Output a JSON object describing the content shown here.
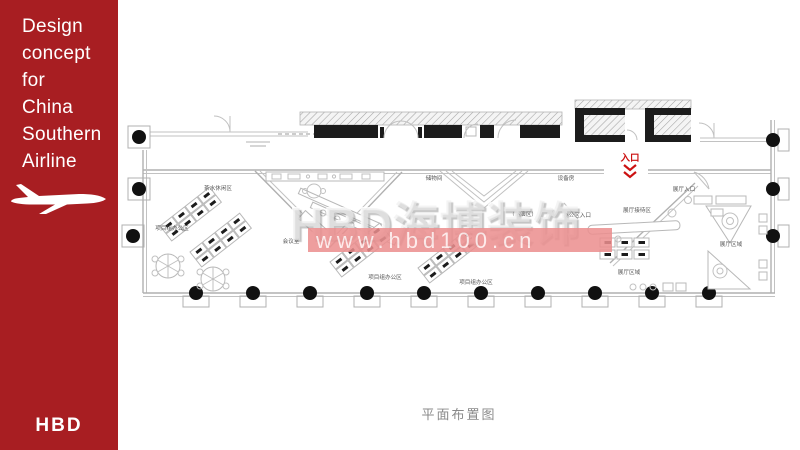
{
  "sidebar": {
    "bg_color": "#a81e22",
    "title_lines": [
      "Design",
      "concept",
      "for",
      "China",
      "Southern",
      "Airline"
    ],
    "logo_text": "HBD"
  },
  "watermark": {
    "brand": "HBD海博装饰",
    "url": "www.hbd100.cn",
    "band_color": "#ec8f8f"
  },
  "floor_plan": {
    "caption": "平面布置图",
    "entrance": {
      "label": "入口",
      "color": "#cc1111"
    },
    "room_labels": [
      {
        "label": "茶水休闲区",
        "x": 100,
        "y": 190
      },
      {
        "label": "项目组办公区",
        "x": 54,
        "y": 230
      },
      {
        "label": "会议室",
        "x": 173,
        "y": 243
      },
      {
        "label": "项目组办公区",
        "x": 267,
        "y": 279
      },
      {
        "label": "项目组办公区",
        "x": 358,
        "y": 284
      },
      {
        "label": "储物间",
        "x": 316,
        "y": 180
      },
      {
        "label": "（路演区）",
        "x": 405,
        "y": 216
      },
      {
        "label": "设备房",
        "x": 448,
        "y": 180
      },
      {
        "label": "办公区入口",
        "x": 459,
        "y": 217
      },
      {
        "label": "展厅接待区",
        "x": 519,
        "y": 212
      },
      {
        "label": "展厅入口",
        "x": 566,
        "y": 191
      },
      {
        "label": "展厅区域",
        "x": 613,
        "y": 246
      },
      {
        "label": "展厅区域",
        "x": 511,
        "y": 274
      }
    ]
  }
}
